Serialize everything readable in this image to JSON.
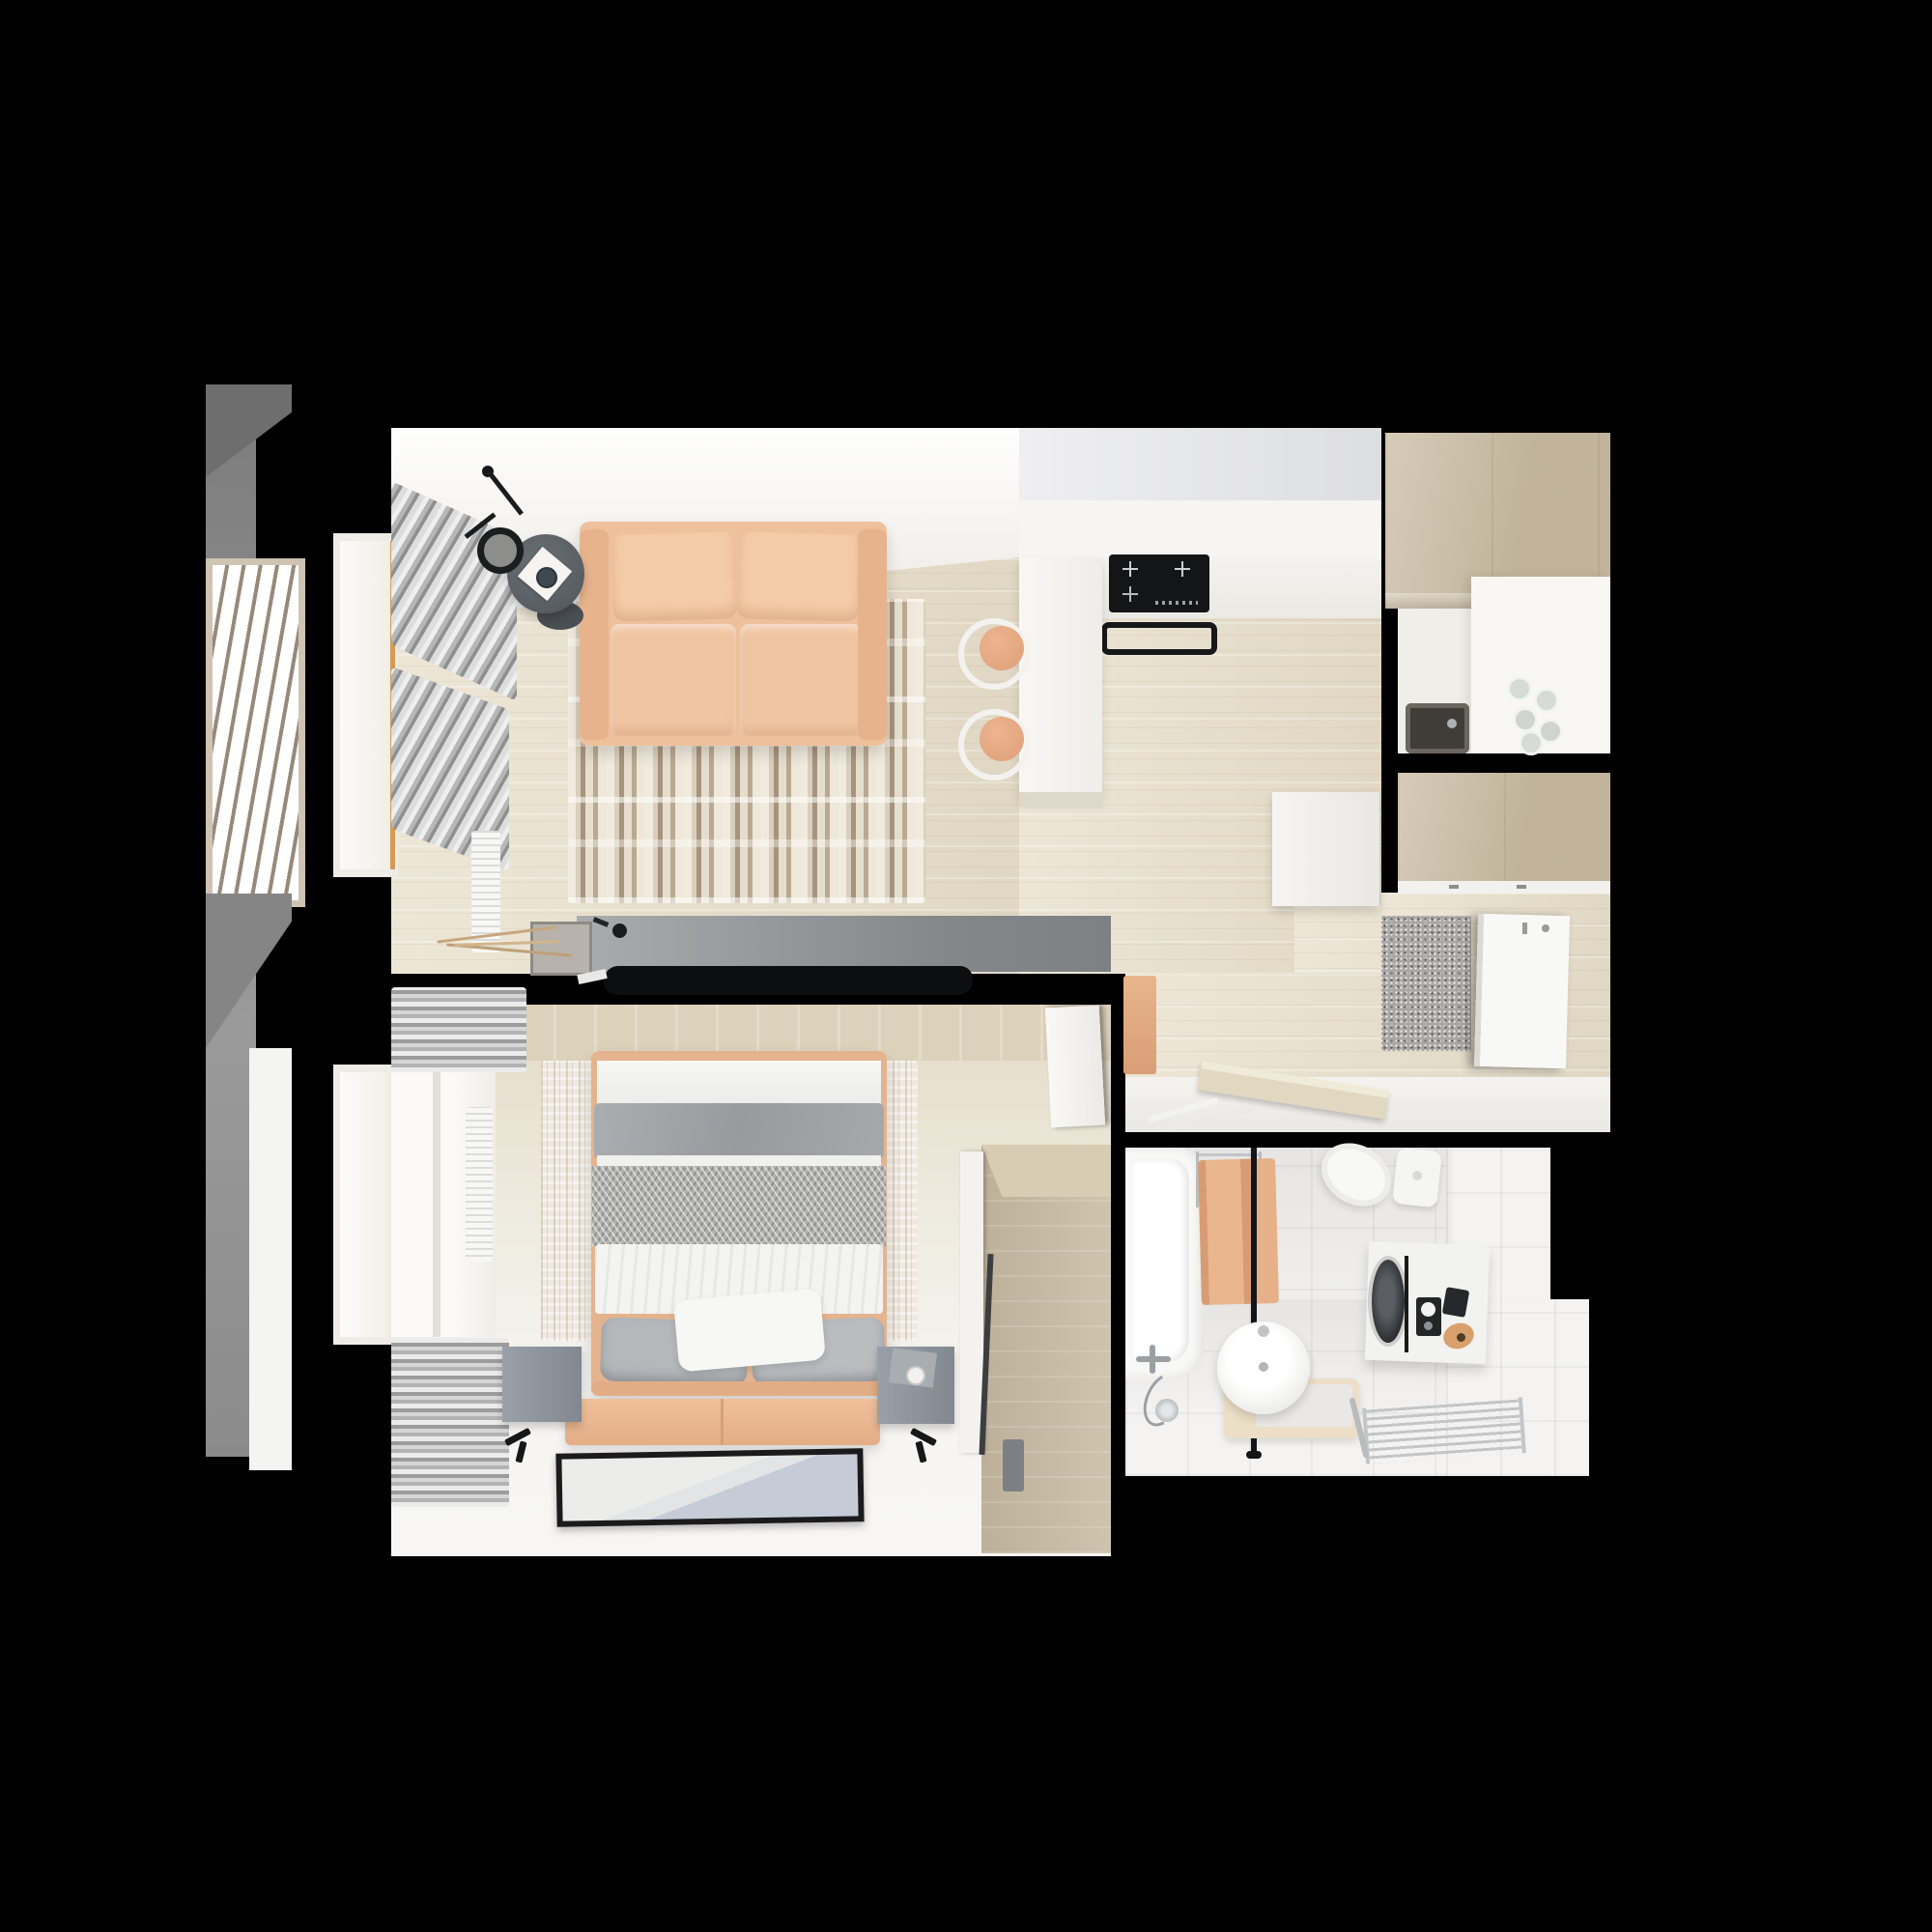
{
  "scene": {
    "type": "3d-floor-plan-top-down-render",
    "description": "Photorealistic top-down 3D render of a small one-bedroom apartment with open living room / kitchen, bedroom, bathroom, entrance hall and a louvered balcony screen on the left. No visible text or UI controls.",
    "background_color": "#000000"
  },
  "palette": {
    "walls": "#000000",
    "wood_floor": "#e9e0cc",
    "bright_floor": "#f5f4f1",
    "white_band": "#f7f6f3",
    "peach_sofa": "#f0c4a2",
    "peach_accent": "#e2a87f",
    "grey_furniture": "#8f9296",
    "coffee_table": "#60666b",
    "tan_cabinet": "#cbbda4",
    "rug_stripe_brown": "#a6947e",
    "bedding_grey": "#a3a7aa",
    "bedding_white": "#f2f2f0",
    "bath_tile": "#f4f3f1",
    "appliance_black": "#141517",
    "chrome": "#c3c6c8",
    "doormat_grey": "#aaa8a4",
    "frame_orange": "#d89a52"
  },
  "rooms": {
    "living_room": {
      "label": "living room",
      "furniture": [
        "two-seat peach sofa",
        "round grey coffee table with book and cup",
        "black arc floor lamp",
        "striped cream-brown area rug",
        "grey tv sideboard",
        "flat black tv",
        "driftwood branch decor in planter",
        "window with grey curtains",
        "white radiator"
      ]
    },
    "kitchen": {
      "label": "kitchen",
      "furniture": [
        "white wall counter",
        "black induction cooktop",
        "black oven front",
        "white bar peninsula",
        "two bentwood chairs with peach seats",
        "tan tall cabinets",
        "white counter with dark sink",
        "drinking glasses"
      ]
    },
    "hallway": {
      "label": "entrance hall",
      "furniture": [
        "tan built-in wardrobe",
        "white shoe cabinet",
        "speckled grey doormat",
        "white entrance door with hooks",
        "peach bench cube",
        "leaning bathroom door leaf"
      ]
    },
    "bedroom": {
      "label": "bedroom",
      "furniture": [
        "double bed with peach frame",
        "grey and white bedding with herringbone throw",
        "white and grey pillows",
        "peach foot bench",
        "two grey nightstands",
        "two black wall reading lamps",
        "distressed beige rug",
        "picture frame leaning on floor",
        "tan wardrobe with slim tv",
        "open white door",
        "window with roman blinds",
        "white radiator"
      ]
    },
    "bathroom": {
      "label": "bathroom",
      "furniture": [
        "white bathtub with chrome shower set",
        "black shower rail",
        "peach towel",
        "chrome towel radiator",
        "round freestanding washbasin on cream platform",
        "washing machine under white counter",
        "black toiletry box",
        "peach jar",
        "white toilet with cistern",
        "chrome towel ladder on floor",
        "white tiled walls"
      ]
    },
    "balcony": {
      "label": "balcony",
      "furniture": [
        "louvered slat screen in beige frame",
        "grey parapet strips"
      ]
    }
  },
  "windows_count": 2,
  "doors_count": 3
}
